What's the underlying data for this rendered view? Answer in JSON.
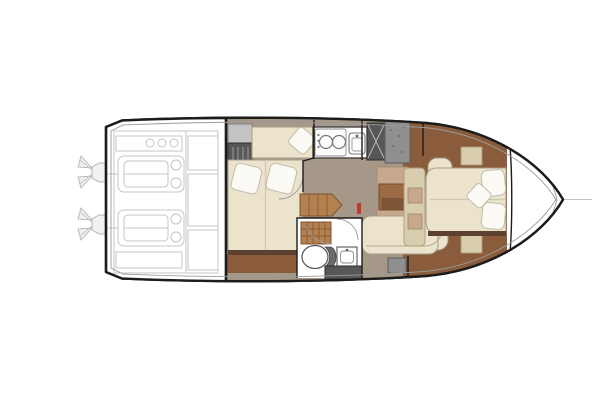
{
  "colors": {
    "ink": "#1c1c1c",
    "line_light": "#c5c5c5",
    "floor_taupe": "#a69888",
    "wood": "#8a5c3b",
    "wood_dark": "#5c4130",
    "wood_table": "#9c6b45",
    "cream": "#ebe3cc",
    "pillow": "#fbfaf5",
    "tan": "#c6a98d",
    "tan_light": "#d9cdb0",
    "gray_dark": "#575757",
    "gray_mid": "#8f8f8f",
    "gray_light": "#c3c3c3",
    "red": "#c0392b"
  },
  "diagram": {
    "type": "floorplan",
    "subject": "motor-yacht lower-deck layout, top view, bow to the right",
    "rooms": [
      {
        "name": "engine-room",
        "position": "stern",
        "features": [
          "twin-engines",
          "twin-sterndrives",
          "machinery-panels"
        ]
      },
      {
        "name": "aft-cabin",
        "position": "amidships-port-of-corridor",
        "features": [
          "double-bed",
          "two-pillows",
          "settee-berth-with-pillow",
          "hanging-wardrobe",
          "cabinet"
        ]
      },
      {
        "name": "galley",
        "position": "amidships-top",
        "features": [
          "two-burner-stove",
          "sink",
          "dark-hatch-x",
          "gray-cabinet"
        ]
      },
      {
        "name": "companionway",
        "position": "center",
        "features": [
          "wood-steps",
          "fire-extinguisher",
          "cabin-door-arc"
        ]
      },
      {
        "name": "head",
        "position": "center-bottom",
        "features": [
          "shower-grate",
          "toilet",
          "washbasin",
          "door-arc",
          "dark-step"
        ]
      },
      {
        "name": "salon-dinette",
        "position": "forward-of-corridor",
        "features": [
          "table",
          "facing-tan-seats",
          "u-shaped-cream-sofa"
        ]
      },
      {
        "name": "bow-cabin",
        "position": "forward",
        "features": [
          "island-bed",
          "pillows",
          "side-tables",
          "tan-bench",
          "wood-sole"
        ]
      },
      {
        "name": "bow-deck",
        "position": "bow-tip",
        "features": [
          "centerline",
          "deck-curve"
        ]
      }
    ]
  }
}
